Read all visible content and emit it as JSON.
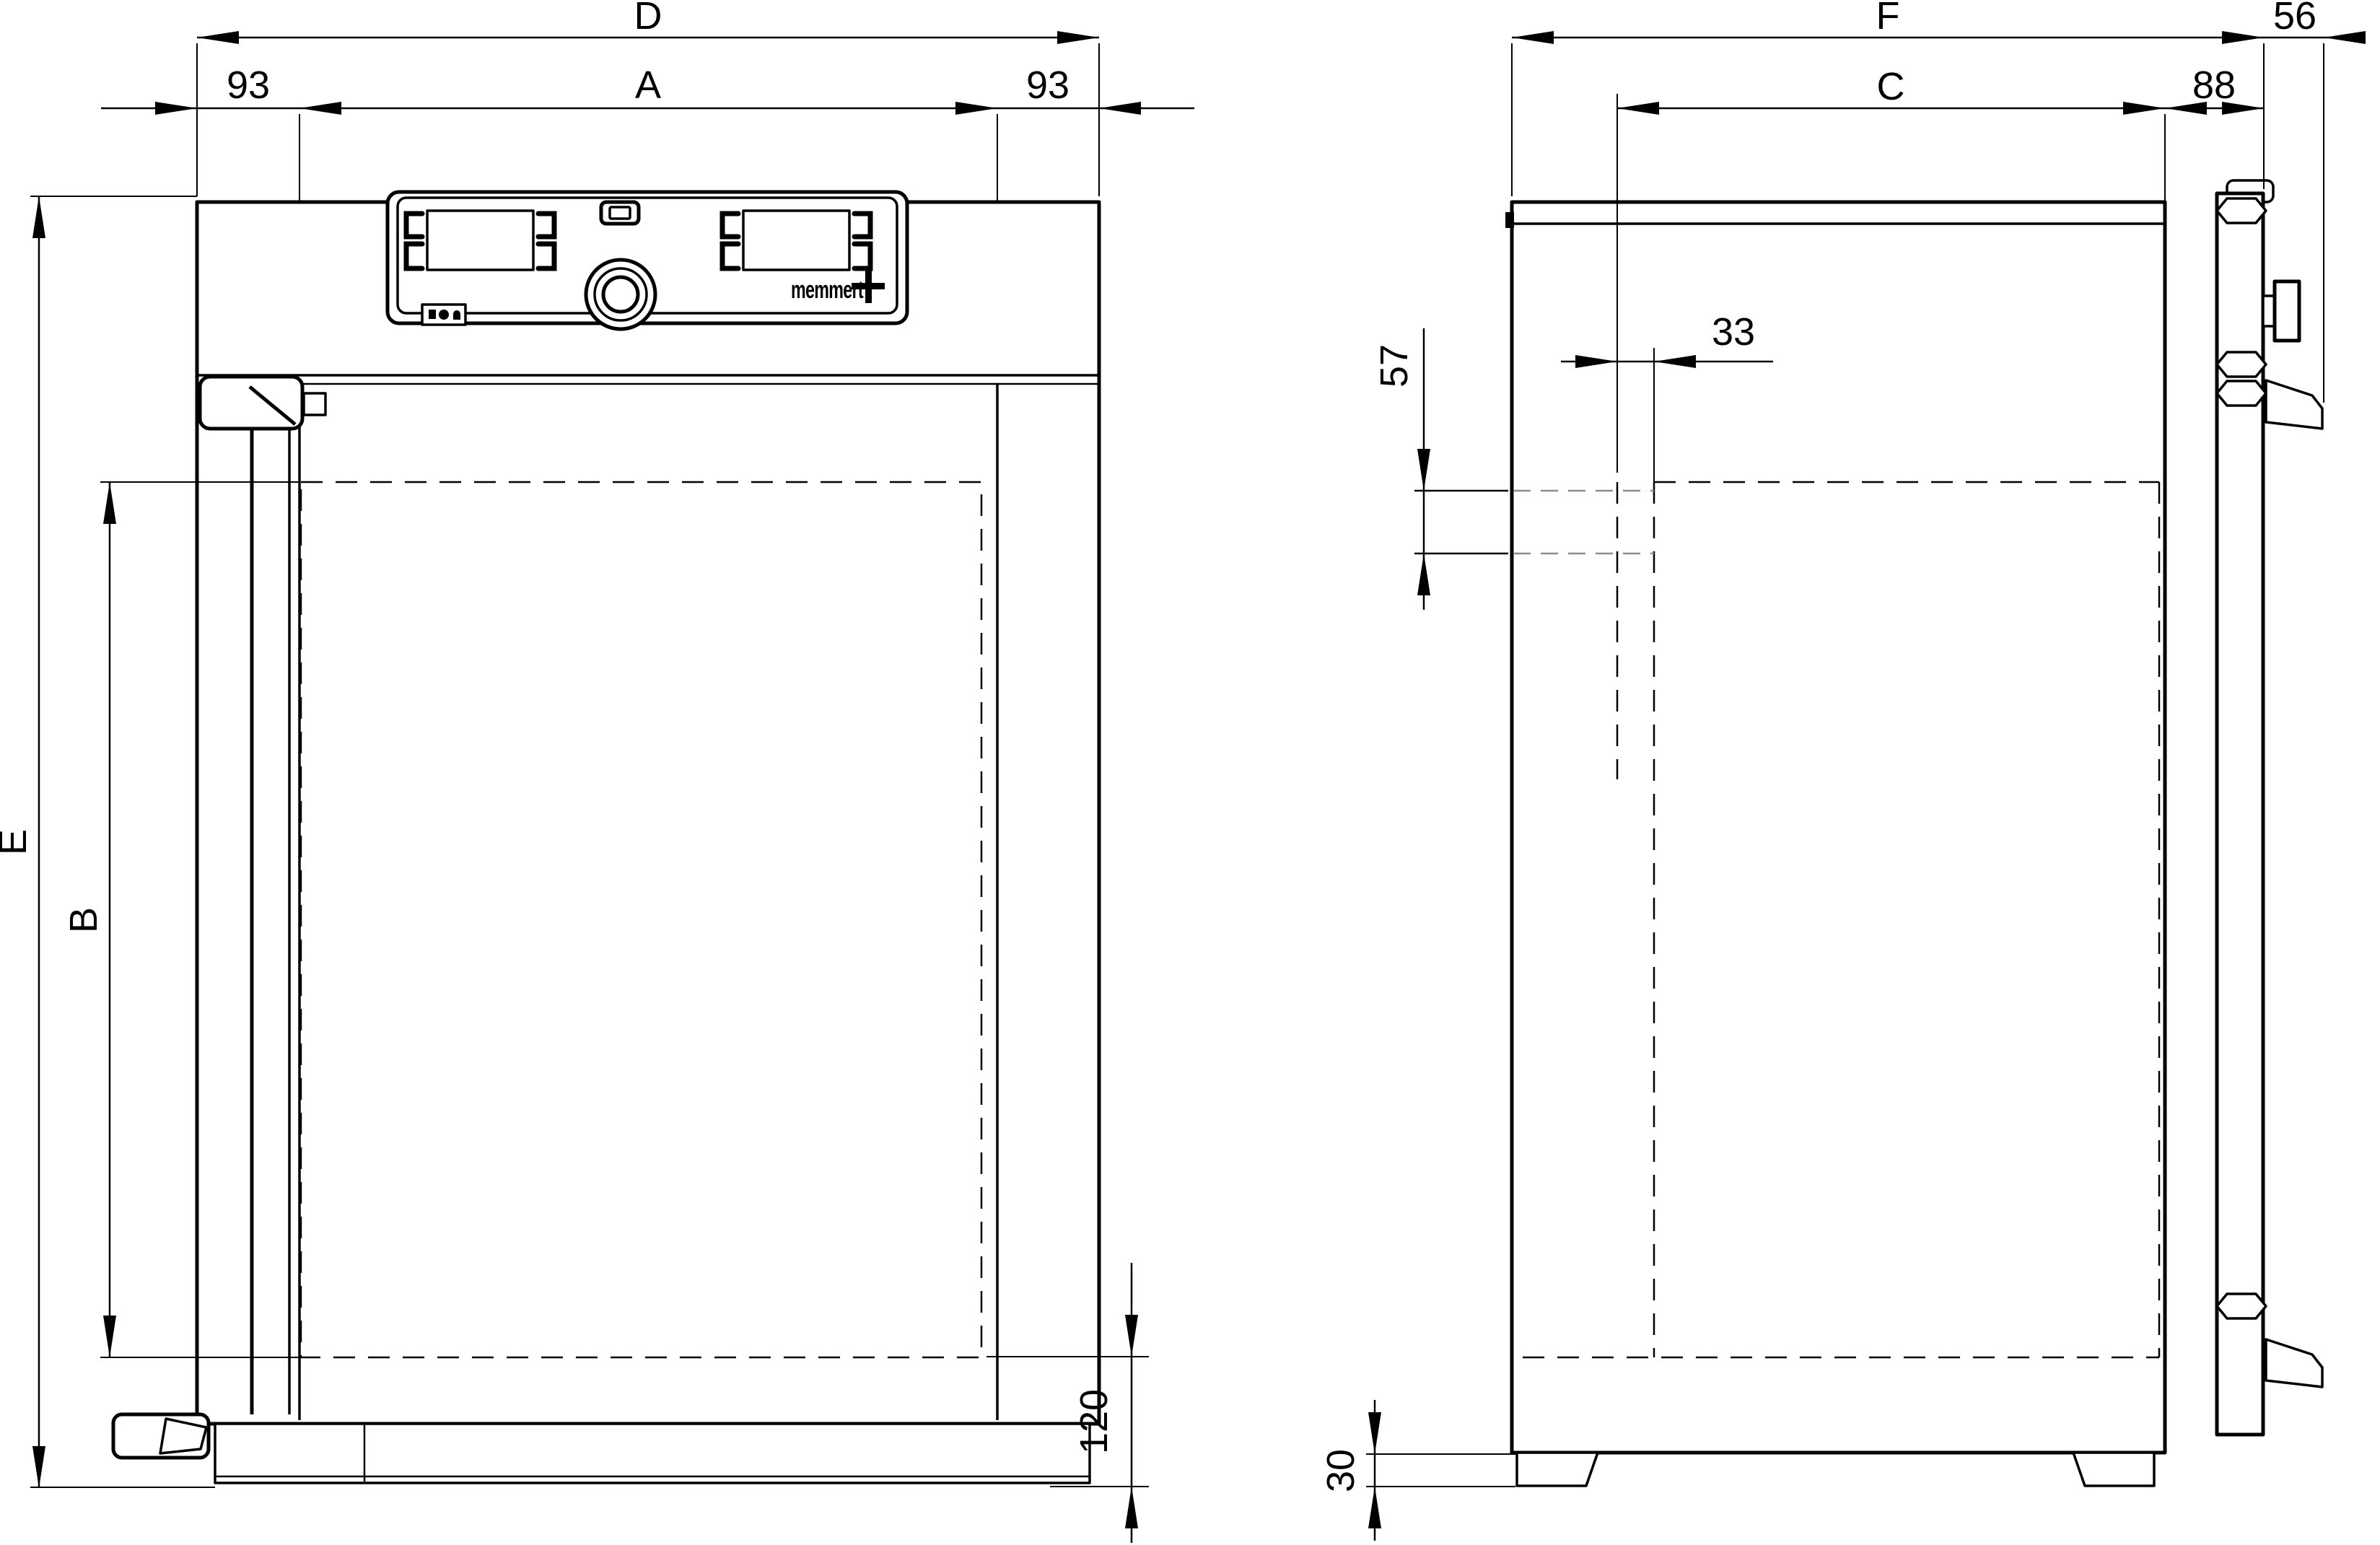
{
  "colors": {
    "line": "#000000",
    "secondary_dash": "#8c8c8c",
    "background": "#ffffff"
  },
  "logo": {
    "text": "memmert",
    "plus": "+"
  },
  "front_view": {
    "dim_total_width": "D",
    "dim_door_width": "A",
    "dim_left_margin": "93",
    "dim_right_margin": "93",
    "dim_total_height": "E",
    "dim_interior_height": "B",
    "dim_base_height": "120"
  },
  "side_view": {
    "dim_total_depth": "F",
    "dim_door_thickness": "56",
    "dim_interior_depth": "C",
    "dim_door_depth": "88",
    "dim_top_inset": "57",
    "dim_back_inset": "33",
    "dim_feet_height": "30"
  }
}
